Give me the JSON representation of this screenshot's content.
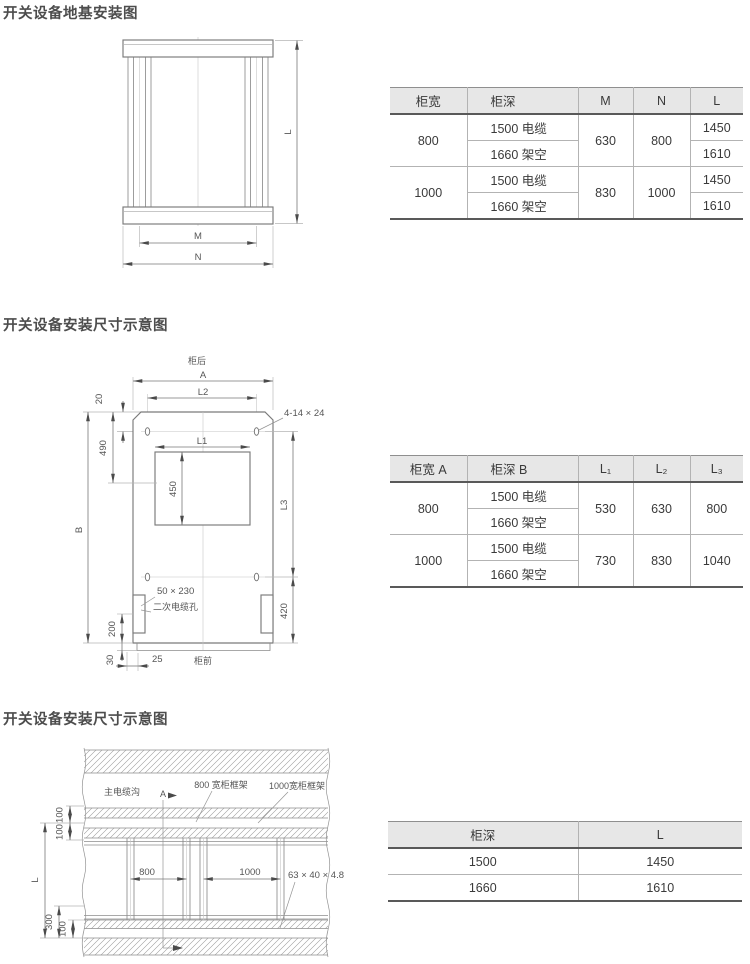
{
  "page": {
    "header_bg": "#e7e7e7",
    "accent_line": "#595959"
  },
  "sections": [
    {
      "title": "开关设备地基安装图",
      "drawing": {
        "dim_l": "L",
        "dim_m": "M",
        "dim_n": "N"
      },
      "table": {
        "headers": [
          "柜宽",
          "柜深",
          "M",
          "N",
          "L"
        ],
        "groups": [
          {
            "width": "800",
            "depth1": "1500 电缆",
            "depth2": "1660 架空",
            "m": "630",
            "n": "800",
            "l1": "1450",
            "l2": "1610"
          },
          {
            "width": "1000",
            "depth1": "1500 电缆",
            "depth2": "1660 架空",
            "m": "830",
            "n": "1000",
            "l1": "1450",
            "l2": "1610"
          }
        ]
      }
    },
    {
      "title": "开关设备安装尺寸示意图",
      "drawing": {
        "back_label": "柜后",
        "front_label": "柜前",
        "dim_a": "A",
        "dim_l2": "L2",
        "dim_20": "20",
        "dim_490": "490",
        "holes_label": "4-14 × 24",
        "dim_l1": "L1",
        "dim_450": "450",
        "dim_b": "B",
        "dim_l3": "L3",
        "dim_420": "420",
        "cable_hole_size": "50 × 230",
        "cable_hole_name": "二次电缆孔",
        "dim_200": "200",
        "dim_30": "30",
        "dim_25": "25"
      },
      "table": {
        "headers": [
          "柜宽 A",
          "柜深 B",
          "L₁",
          "L₂",
          "L₃"
        ],
        "groups": [
          {
            "width": "800",
            "depth1": "1500 电缆",
            "depth2": "1660 架空",
            "c1": "530",
            "c2": "630",
            "c3": "800"
          },
          {
            "width": "1000",
            "depth1": "1500 电缆",
            "depth2": "1660 架空",
            "c1": "730",
            "c2": "830",
            "c3": "1040"
          }
        ]
      }
    },
    {
      "title": "开关设备安装尺寸示意图",
      "drawing": {
        "trench_label": "主电缆沟",
        "section_label": "A",
        "frame800_label": "800 宽柜框架",
        "frame1000_label": "1000宽柜框架",
        "dim_100a": "100",
        "dim_100b": "100",
        "dim_l": "L",
        "dim_300": "300",
        "dim_100c": "100",
        "dim_800": "800",
        "dim_1000": "1000",
        "angle_label": "63 × 40 × 4.8"
      },
      "table": {
        "headers": [
          "柜深",
          "L"
        ],
        "rows": [
          [
            "1500",
            "1450"
          ],
          [
            "1660",
            "1610"
          ]
        ]
      }
    }
  ]
}
